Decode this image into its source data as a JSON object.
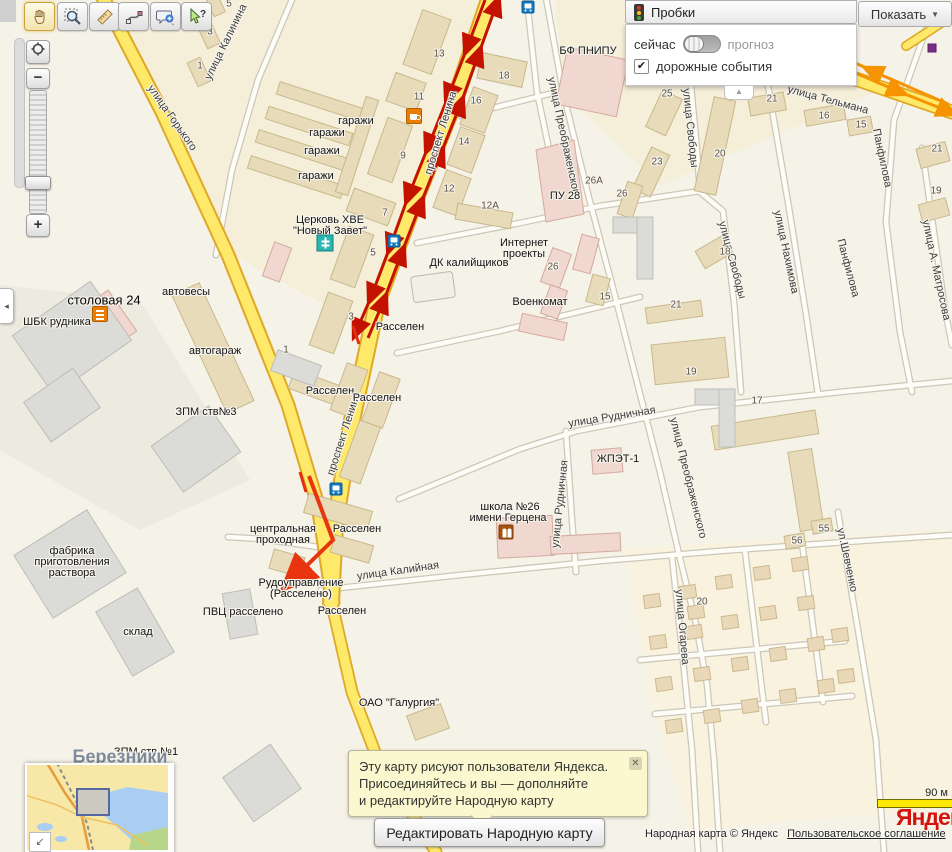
{
  "toolbar": {
    "tools": [
      "pan-hand",
      "zoom-select",
      "ruler",
      "route",
      "add-comment",
      "whats-here"
    ]
  },
  "zoom_control": {
    "minus": "−",
    "plus": "+"
  },
  "left_tab_glyph": "◂",
  "panel_tab_glyph": "▲",
  "traffic": {
    "title": "Пробки",
    "show": "Показать",
    "show_arrow": "▼",
    "now": "сейчас",
    "forecast": "прогноз",
    "events": "дорожные события",
    "events_checked": "✔"
  },
  "bubble": {
    "l1": "Эту карту рисуют пользователи Яндекса.",
    "l2": "Присоединяйтесь и вы — дополня­йте",
    "l3": "и редактируйте Народную карту",
    "close": "✕"
  },
  "edit_button": {
    "label": "Редактировать Народную карту"
  },
  "attribution": {
    "text": "Народная карта © Яндекс",
    "link": "Пользовательское соглашение"
  },
  "scale": {
    "label": "90 м"
  },
  "logo": {
    "text": "Яндекс"
  },
  "minimap": {
    "collapse_glyph": "↙"
  },
  "colors": {
    "road_major": "#ffe96a",
    "road_casing": "#dfa826",
    "traffic_red": "#c41200",
    "arrow_orange": "#f59300",
    "event_red": "#e8350f",
    "event_purple": "#7b2d8b",
    "building_beige": "#e8dbb9",
    "building_pink": "#f0d7cf",
    "building_gray": "#dbdbd8"
  },
  "map": {
    "labels": [
      {
        "t": "улица Горького",
        "x": 172,
        "y": 118,
        "r": 55,
        "c": "street"
      },
      {
        "t": "улица Калинина",
        "x": 226,
        "y": 42,
        "r": -64,
        "c": "street"
      },
      {
        "t": "проспект Ленина",
        "x": 441,
        "y": 133,
        "r": -73,
        "c": "street"
      },
      {
        "t": "проспект Ленина",
        "x": 344,
        "y": 434,
        "r": -72,
        "c": "street"
      },
      {
        "t": "улица Тельмана",
        "x": 828,
        "y": 100,
        "r": 15,
        "c": "street"
      },
      {
        "t": "улица Преображенского",
        "x": 564,
        "y": 138,
        "r": 78,
        "c": "street"
      },
      {
        "t": "улица Преображенского",
        "x": 688,
        "y": 478,
        "r": 76,
        "c": "street"
      },
      {
        "t": "улица Свободы",
        "x": 690,
        "y": 128,
        "r": 84,
        "c": "street"
      },
      {
        "t": "улица Свободы",
        "x": 732,
        "y": 260,
        "r": 75,
        "c": "street"
      },
      {
        "t": "улица Нахимова",
        "x": 786,
        "y": 252,
        "r": 78,
        "c": "street"
      },
      {
        "t": "Панфилова",
        "x": 882,
        "y": 158,
        "r": 78,
        "c": "street"
      },
      {
        "t": "Панфилова",
        "x": 848,
        "y": 268,
        "r": 75,
        "c": "street"
      },
      {
        "t": "улица А. Матросова",
        "x": 936,
        "y": 270,
        "r": 78,
        "c": "street"
      },
      {
        "t": "улица Рудничная",
        "x": 612,
        "y": 417,
        "r": -9,
        "c": "street"
      },
      {
        "t": "улица Рудничная",
        "x": 560,
        "y": 504,
        "r": -84,
        "c": "street"
      },
      {
        "t": "улица Калийная",
        "x": 398,
        "y": 571,
        "r": -8,
        "c": "street"
      },
      {
        "t": "улица Огарева",
        "x": 682,
        "y": 627,
        "r": 85,
        "c": "street"
      },
      {
        "t": "ул.Шевченко",
        "x": 847,
        "y": 560,
        "r": 78,
        "c": "street"
      },
      {
        "t": "гаражи",
        "x": 356,
        "y": 121,
        "r": 0,
        "c": "poi"
      },
      {
        "t": "гаражи",
        "x": 327,
        "y": 133,
        "r": 0,
        "c": "poi"
      },
      {
        "t": "гаражи",
        "x": 322,
        "y": 151,
        "r": 0,
        "c": "poi"
      },
      {
        "t": "гаражи",
        "x": 316,
        "y": 176,
        "r": 0,
        "c": "poi"
      },
      {
        "t": "Церковь ХВЕ",
        "x": 330,
        "y": 220,
        "r": 0,
        "c": "poi"
      },
      {
        "t": "\"Новый Завет\"",
        "x": 330,
        "y": 231,
        "r": 0,
        "c": "poi"
      },
      {
        "t": "столовая 24",
        "x": 104,
        "y": 300,
        "r": 0,
        "c": "poi-lg"
      },
      {
        "t": "ШБК рудника",
        "x": 57,
        "y": 322,
        "r": 0,
        "c": "poi"
      },
      {
        "t": "автовесы",
        "x": 186,
        "y": 292,
        "r": 0,
        "c": "poi"
      },
      {
        "t": "автогараж",
        "x": 215,
        "y": 351,
        "r": 0,
        "c": "poi"
      },
      {
        "t": "ЗПМ ств№3",
        "x": 206,
        "y": 412,
        "r": 0,
        "c": "poi"
      },
      {
        "t": "фабрика",
        "x": 72,
        "y": 551,
        "r": 0,
        "c": "poi"
      },
      {
        "t": "приготовления",
        "x": 72,
        "y": 562,
        "r": 0,
        "c": "poi"
      },
      {
        "t": "раствора",
        "x": 72,
        "y": 573,
        "r": 0,
        "c": "poi"
      },
      {
        "t": "склад",
        "x": 138,
        "y": 632,
        "r": 0,
        "c": "poi"
      },
      {
        "t": "центральная",
        "x": 283,
        "y": 529,
        "r": 0,
        "c": "poi"
      },
      {
        "t": "проходная",
        "x": 283,
        "y": 540,
        "r": 0,
        "c": "poi"
      },
      {
        "t": "Рудоуправление",
        "x": 301,
        "y": 583,
        "r": 0,
        "c": "poi"
      },
      {
        "t": "(Расселено)",
        "x": 301,
        "y": 594,
        "r": 0,
        "c": "poi"
      },
      {
        "t": "ПВЦ расселено",
        "x": 243,
        "y": 612,
        "r": 0,
        "c": "poi"
      },
      {
        "t": "Расселен",
        "x": 342,
        "y": 611,
        "r": 0,
        "c": "poi"
      },
      {
        "t": "Расселен",
        "x": 400,
        "y": 327,
        "r": 0,
        "c": "poi"
      },
      {
        "t": "Расселен",
        "x": 330,
        "y": 391,
        "r": 0,
        "c": "poi"
      },
      {
        "t": "Расселен",
        "x": 377,
        "y": 398,
        "r": 0,
        "c": "poi"
      },
      {
        "t": "Расселен",
        "x": 357,
        "y": 529,
        "r": 0,
        "c": "poi"
      },
      {
        "t": "ОАО \"Галургия\"",
        "x": 399,
        "y": 703,
        "r": 0,
        "c": "poi"
      },
      {
        "t": "школа №26",
        "x": 510,
        "y": 507,
        "r": 0,
        "c": "poi"
      },
      {
        "t": "имени Герцена",
        "x": 508,
        "y": 518,
        "r": 0,
        "c": "poi"
      },
      {
        "t": "Интернет",
        "x": 524,
        "y": 243,
        "r": 0,
        "c": "poi"
      },
      {
        "t": "проекты",
        "x": 524,
        "y": 254,
        "r": 0,
        "c": "poi"
      },
      {
        "t": "ДК калийщиков",
        "x": 469,
        "y": 263,
        "r": 0,
        "c": "poi"
      },
      {
        "t": "Военкомат",
        "x": 540,
        "y": 302,
        "r": 0,
        "c": "poi"
      },
      {
        "t": "ПУ 28",
        "x": 565,
        "y": 196,
        "r": 0,
        "c": "poi"
      },
      {
        "t": "БФ ПНИПУ",
        "x": 588,
        "y": 51,
        "r": 0,
        "c": "poi"
      },
      {
        "t": "ЖПЭТ-1",
        "x": 618,
        "y": 459,
        "r": 0,
        "c": "poi"
      },
      {
        "t": "ЗПМ ств №1",
        "x": 146,
        "y": 752,
        "r": 0,
        "c": "poi"
      },
      {
        "t": "Березники",
        "x": 120,
        "y": 757,
        "r": 0,
        "c": "city"
      },
      {
        "t": "7",
        "x": 385,
        "y": 213,
        "r": 0,
        "c": "num"
      },
      {
        "t": "5",
        "x": 373,
        "y": 253,
        "r": 0,
        "c": "num"
      },
      {
        "t": "3",
        "x": 351,
        "y": 317,
        "r": 0,
        "c": "num"
      },
      {
        "t": "9",
        "x": 403,
        "y": 156,
        "r": 0,
        "c": "num"
      },
      {
        "t": "11",
        "x": 419,
        "y": 97,
        "r": 0,
        "c": "num"
      },
      {
        "t": "13",
        "x": 439,
        "y": 54,
        "r": 0,
        "c": "num"
      },
      {
        "t": "12",
        "x": 449,
        "y": 189,
        "r": 0,
        "c": "num"
      },
      {
        "t": "14",
        "x": 464,
        "y": 142,
        "r": 0,
        "c": "num"
      },
      {
        "t": "16",
        "x": 476,
        "y": 101,
        "r": 0,
        "c": "num"
      },
      {
        "t": "18",
        "x": 504,
        "y": 76,
        "r": 0,
        "c": "num"
      },
      {
        "t": "12А",
        "x": 490,
        "y": 206,
        "r": 0,
        "c": "num"
      },
      {
        "t": "26А",
        "x": 594,
        "y": 181,
        "r": 0,
        "c": "num"
      },
      {
        "t": "26",
        "x": 622,
        "y": 194,
        "r": 0,
        "c": "num"
      },
      {
        "t": "26",
        "x": 553,
        "y": 267,
        "r": 0,
        "c": "num"
      },
      {
        "t": "15",
        "x": 605,
        "y": 297,
        "r": 0,
        "c": "num"
      },
      {
        "t": "21",
        "x": 676,
        "y": 305,
        "r": 0,
        "c": "num"
      },
      {
        "t": "23",
        "x": 657,
        "y": 162,
        "r": 0,
        "c": "num"
      },
      {
        "t": "25",
        "x": 667,
        "y": 94,
        "r": 0,
        "c": "num"
      },
      {
        "t": "20",
        "x": 720,
        "y": 154,
        "r": 0,
        "c": "num"
      },
      {
        "t": "18",
        "x": 725,
        "y": 252,
        "r": 0,
        "c": "num"
      },
      {
        "t": "21",
        "x": 772,
        "y": 99,
        "r": 0,
        "c": "num"
      },
      {
        "t": "16",
        "x": 824,
        "y": 116,
        "r": 0,
        "c": "num"
      },
      {
        "t": "15",
        "x": 861,
        "y": 125,
        "r": 0,
        "c": "num"
      },
      {
        "t": "21",
        "x": 937,
        "y": 149,
        "r": 0,
        "c": "num"
      },
      {
        "t": "19",
        "x": 936,
        "y": 191,
        "r": 0,
        "c": "num"
      },
      {
        "t": "19",
        "x": 691,
        "y": 372,
        "r": 0,
        "c": "num"
      },
      {
        "t": "17",
        "x": 757,
        "y": 401,
        "r": 0,
        "c": "num"
      },
      {
        "t": "55",
        "x": 824,
        "y": 529,
        "r": 0,
        "c": "num"
      },
      {
        "t": "56",
        "x": 797,
        "y": 541,
        "r": 0,
        "c": "num"
      },
      {
        "t": "20",
        "x": 702,
        "y": 602,
        "r": 0,
        "c": "num"
      },
      {
        "t": "1",
        "x": 286,
        "y": 350,
        "r": 0,
        "c": "num"
      },
      {
        "t": "1",
        "x": 200,
        "y": 66,
        "r": 0,
        "c": "num"
      },
      {
        "t": "3",
        "x": 210,
        "y": 32,
        "r": 0,
        "c": "num"
      },
      {
        "t": "5",
        "x": 229,
        "y": 4,
        "r": 0,
        "c": "num"
      }
    ],
    "icons": [
      {
        "type": "bus",
        "x": 528,
        "y": 7
      },
      {
        "type": "bus",
        "x": 394,
        "y": 241
      },
      {
        "type": "bus",
        "x": 336,
        "y": 489
      },
      {
        "type": "church",
        "x": 325,
        "y": 243
      },
      {
        "type": "cafe",
        "x": 414,
        "y": 116
      },
      {
        "type": "canteen",
        "x": 100,
        "y": 314
      },
      {
        "type": "school",
        "x": 506,
        "y": 532
      }
    ]
  }
}
